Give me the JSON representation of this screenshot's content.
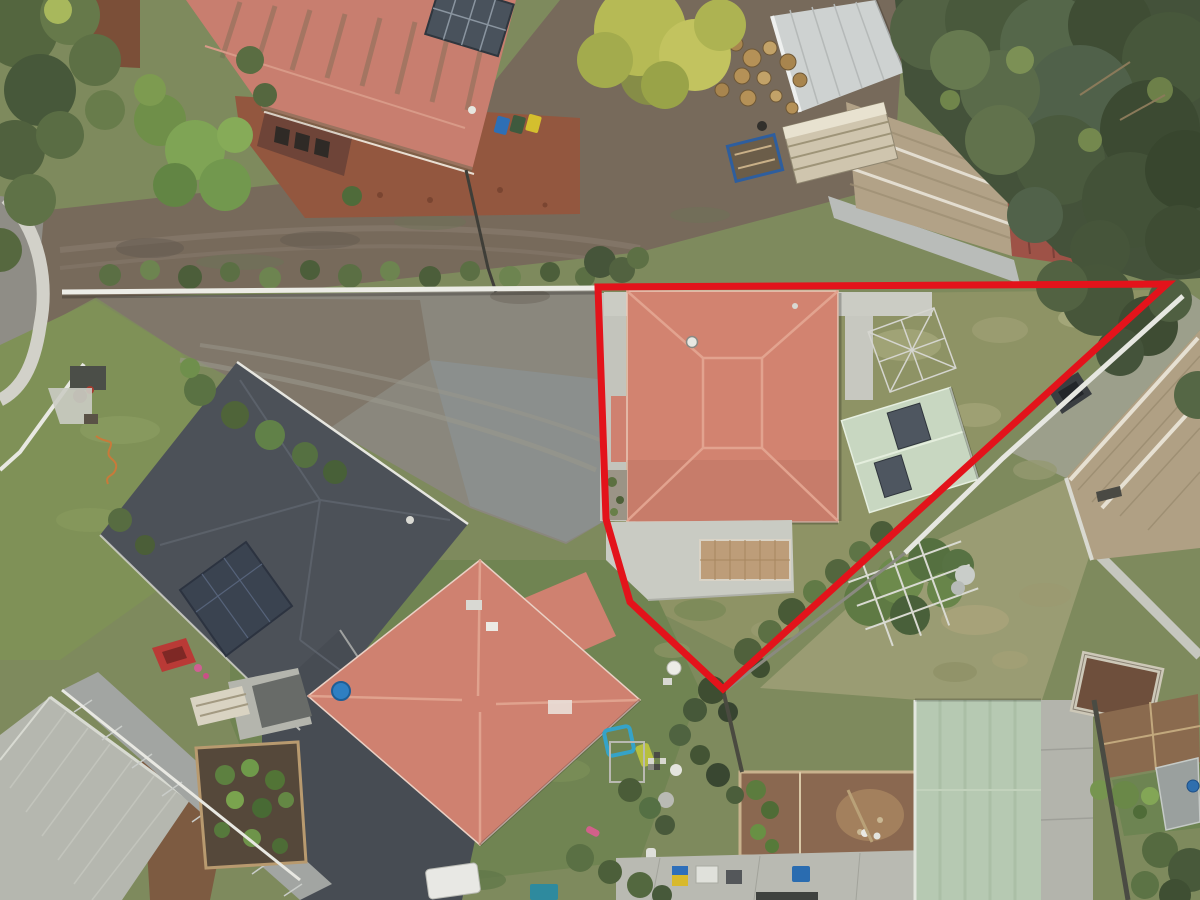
{
  "meta": {
    "title": "Aerial drone photograph of residential properties with red property-boundary outline",
    "image_type": "aerial-photograph",
    "width": 1200,
    "height": 900
  },
  "boundary": {
    "label": "property-boundary",
    "color": "#e3131b",
    "stroke_width": 7,
    "points": "598,287 1167,284 723,689 630,602 606,519",
    "closed": true
  },
  "palette": {
    "grass_base": "#7e8a5d",
    "grass_dry": "#a5a77a",
    "lawn_subject": "#8e9365",
    "dirt_road": "#776a5b",
    "street_asphalt": "#8f8d86",
    "kerb_concrete": "#d2d1c9",
    "gravel_driveway": "#8a877d",
    "white_wall": "#ecece6",
    "subject_roof_salmon": "#d28370",
    "neighbour_roof_salmon": "#cf8170",
    "topleft_roof_red": "#c87e6f",
    "dark_roof_charcoal": "#4c5158",
    "light_roof_gray": "#b5b7af",
    "shed_green": "#c8d7c1",
    "building_green_pale": "#b6c9b2",
    "shed_tan": "#b2a287",
    "garage_tan": "#b0a084",
    "conifer_dark": "#44523a",
    "tree_yellow_green": "#b6ba55",
    "concrete_path": "#c9cbc3",
    "brick_paving": "#93573f",
    "soil_brown": "#8a6a4e"
  },
  "scene": {
    "description": "Top-down drone photo of a suburban block. A bright red outline marks a triangular property containing a salmon hip-roof house, concrete driveway, pale-green garden shed, rotary clothesline and lawn. Around it: a dirt lane and curved street top-left, a large red-roof building top-left, a wood yard with sheds top-right under dark conifers, a charcoal-roof house and second salmon-roof house lower-left, a light-gray roof bottom-left, a pale-green roof and vegetable gardens bottom-right.",
    "objects": [
      {
        "name": "property-boundary-overlay",
        "kind": "annotation",
        "color": "#e3131b"
      },
      {
        "name": "subject-house",
        "kind": "salmon hip roof",
        "color": "#d28370"
      },
      {
        "name": "subject-driveway",
        "kind": "concrete with brick inset",
        "color": "#c9cbc3"
      },
      {
        "name": "garden-shed-green",
        "kind": "gable shed with skylights",
        "color": "#c8d7c1"
      },
      {
        "name": "rotary-clothesline",
        "kind": "clothes hoist",
        "color": "#d5d5cf"
      },
      {
        "name": "outdoor-table",
        "kind": "white round table",
        "color": "#ecece6"
      },
      {
        "name": "neighbour-building-top-left",
        "kind": "large red roof",
        "color": "#c87e6f"
      },
      {
        "name": "wheelie-bins",
        "kind": "blue, green, yellow bins",
        "color": "#2e6fb5"
      },
      {
        "name": "white-shed",
        "kind": "metal shed",
        "color": "#ced2d1"
      },
      {
        "name": "tan-shed",
        "kind": "machinery shed with red section",
        "color": "#b2a287"
      },
      {
        "name": "wood-pile",
        "kind": "cut logs",
        "color": "#c2a268"
      },
      {
        "name": "lumber-stack",
        "kind": "stacked sheets",
        "color": "#cfc5ae"
      },
      {
        "name": "blue-trailer",
        "kind": "box trailer",
        "color": "#2e5e9e"
      },
      {
        "name": "charcoal-roof-house",
        "kind": "dark hip roof with solar panels",
        "color": "#4c5158"
      },
      {
        "name": "salmon-roof-house-2",
        "kind": "diamond-oriented hip roof",
        "color": "#cf8170"
      },
      {
        "name": "paddling-pool",
        "kind": "blue round pool",
        "color": "#2f7fc2"
      },
      {
        "name": "trampoline",
        "kind": "blue square frame",
        "color": "#35a3c8"
      },
      {
        "name": "light-gray-roof-building",
        "kind": "corrugated hip roof",
        "color": "#b5b7af"
      },
      {
        "name": "glass-skillion",
        "kind": "glazed lean-to",
        "color": "#a2a5a2"
      },
      {
        "name": "red-car",
        "kind": "parked car",
        "color": "#b93a36"
      },
      {
        "name": "vegetable-garden",
        "kind": "raised beds",
        "color": "#55483a"
      },
      {
        "name": "chicken-pen",
        "kind": "fenced dirt run with white hens",
        "color": "#8a6850"
      },
      {
        "name": "pale-green-building",
        "kind": "long corrugated roof",
        "color": "#b6c9b2"
      },
      {
        "name": "garden-beds-right",
        "kind": "stone and timber plots",
        "color": "#8a6a4e"
      },
      {
        "name": "tan-garage-right",
        "kind": "corrugated garage",
        "color": "#b0a084"
      },
      {
        "name": "conifer-trees",
        "kind": "dense evergreens",
        "color": "#44523a"
      },
      {
        "name": "yellow-green-tree",
        "kind": "deciduous tree",
        "color": "#b6ba55"
      },
      {
        "name": "street-and-kerb",
        "kind": "curved road corner",
        "color": "#8f8d86"
      },
      {
        "name": "dirt-lane",
        "kind": "unsealed road",
        "color": "#776a5b"
      },
      {
        "name": "white-retaining-wall",
        "kind": "boundary wall",
        "color": "#ecece6"
      }
    ]
  }
}
